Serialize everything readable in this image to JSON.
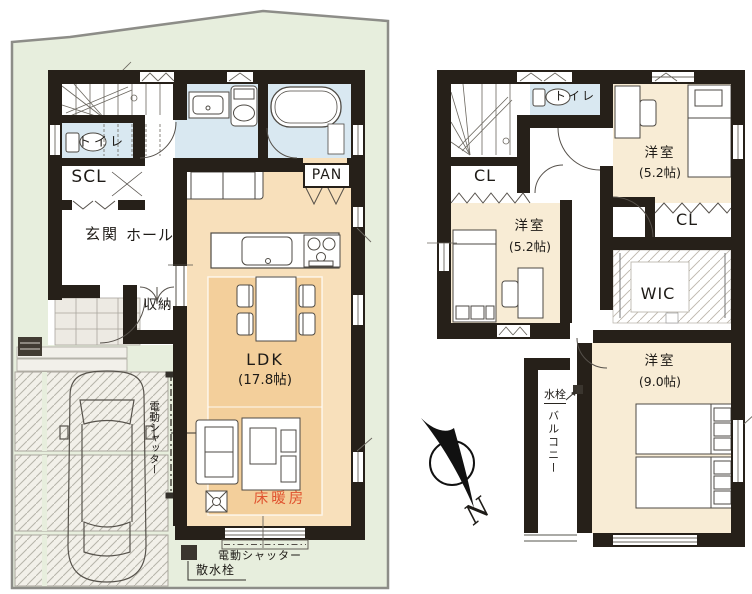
{
  "plan_type": "residential-floor-plan",
  "colors": {
    "wall": "#262019",
    "wet_room_floor": "#d9e8f1",
    "ldk_floor": "#f8e0bb",
    "floor_heating_fill": "#f3cf9b",
    "bedroom_floor": "#f8ecd5",
    "site_green": "#e7eedd",
    "heating_text": "#e0532f"
  },
  "f1": {
    "toilet_label": "トイレ",
    "scl_label": "SCL",
    "genkan_label": "玄関",
    "hall_label": "ホール",
    "storage_label": "収納",
    "pantry_label": "PAN",
    "ldk_label": "LDK",
    "ldk_size": "(17.8帖)",
    "floor_heating_label": "床暖房",
    "garage_shutter_label": "電動シャッター",
    "window_shutter_label": "電動シャッター",
    "sprinkler_label": "散水栓"
  },
  "f2": {
    "toilet_label": "トイレ",
    "closet_left_label": "CL",
    "closet_right_label": "CL",
    "wic_label": "WIC",
    "bedroom1_label": "洋室",
    "bedroom1_size": "(5.2帖)",
    "bedroom2_label": "洋室",
    "bedroom2_size": "(5.2帖)",
    "bedroom3_label": "洋室",
    "bedroom3_size": "(9.0帖)",
    "balcony_label": "バルコニー",
    "faucet_label": "水栓"
  },
  "compass": {
    "north_label": "N"
  }
}
